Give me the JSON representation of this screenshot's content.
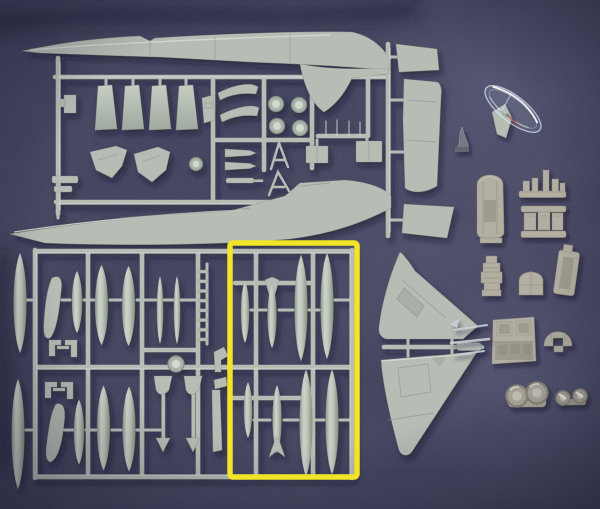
{
  "scene": {
    "subject": "Aircraft model kit contents: gray injection-molded sprues, resin detail parts and a clear canopy laid out on dark navy fabric",
    "highlight_note": "A yellow rectangle is drawn over the photo highlighting the drop-tank / external stores section of the weapons sprue"
  },
  "colors": {
    "bg": "#383852",
    "plastic": "#b5bdb5",
    "plasticLight": "#d8ded6",
    "plasticDark": "#86917f",
    "resin": "#b2aea2",
    "resinLight": "#ccc8bc",
    "resinDark": "#8e8a7e",
    "metalDark": "#757983",
    "canopyLine": "#dce8f4",
    "highlight": "#f2e426",
    "shadow": "#10102c"
  },
  "highlight_box": {
    "x": 230,
    "y": 243,
    "width": 127,
    "height": 234,
    "stroke_width": 5.5
  },
  "groups": [
    {
      "id": "airframe-sprue",
      "label": "Main sprue: fuselage halves, flaps, airbrakes, wheels, gear doors, antennas"
    },
    {
      "id": "wing-parts",
      "label": "Wing and stabilizer panels on vertical runner"
    },
    {
      "id": "weapons-sprue",
      "label": "Weapons sprue: drop tanks, bombs, missile rails, pylons"
    },
    {
      "id": "tail-fin-halves",
      "label": "Two vertical-tail halves joined by a short runner"
    },
    {
      "id": "clear-canopy",
      "label": "Clear canopy part"
    },
    {
      "id": "resin-parts",
      "label": "Resin cockpit tub, seat, panels, coaming, exhaust dome and wheels"
    },
    {
      "id": "highlight-box",
      "label": "Yellow highlight rectangle over drop-tank section"
    }
  ],
  "inventory": {
    "flap_parts": 4,
    "wheel_discs": 5,
    "gear_doors": 2,
    "large_drop_tanks_in_box": 4,
    "small_stores_in_box": 4,
    "loose_big_tanks_left": 2,
    "resin_wheel_pairs": 2
  }
}
